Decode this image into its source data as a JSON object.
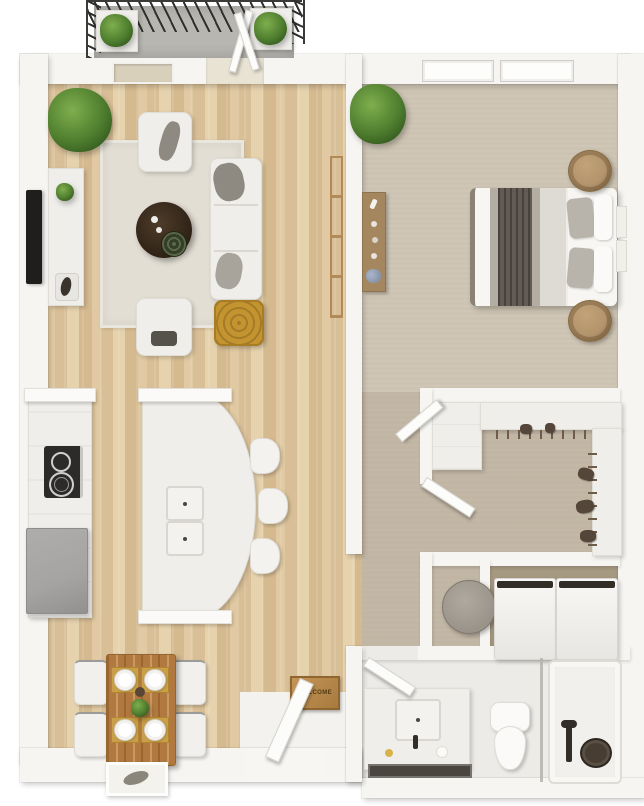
{
  "scene": {
    "type": "3d-floor-plan-top-view",
    "description": "One-bedroom apartment 3D floor plan, top-down render",
    "welcome_sign_text": "WELCOME"
  },
  "rooms": [
    {
      "name": "balcony",
      "features": [
        "railing",
        "planter",
        "planter",
        "open-glass-door"
      ]
    },
    {
      "name": "living-room",
      "features": [
        "potted-plant",
        "wall-tv",
        "media-console",
        "area-rug",
        "armchair",
        "armchair",
        "sofa",
        "round-coffee-table",
        "gold-pouf",
        "blanket-ladder",
        "window"
      ]
    },
    {
      "name": "kitchen",
      "features": [
        "wall-counter",
        "cooktop",
        "refrigerator",
        "curved-island",
        "double-sink",
        "bar-stool",
        "bar-stool",
        "bar-stool"
      ]
    },
    {
      "name": "dining-area",
      "features": [
        "wood-table",
        "dining-chair",
        "dining-chair",
        "dining-chair",
        "dining-chair",
        "place-setting-x4",
        "framed-mat"
      ]
    },
    {
      "name": "bedroom",
      "features": [
        "double-bed",
        "grey-blanket",
        "pillows",
        "nightstand",
        "nightstand",
        "console-dresser",
        "potted-plant",
        "window",
        "window",
        "wall-art"
      ]
    },
    {
      "name": "hallway",
      "features": [
        "open-door",
        "open-door"
      ]
    },
    {
      "name": "walk-in-closet",
      "features": [
        "built-in-wardrobe",
        "hanging-rod",
        "hanging-clothes",
        "open-door"
      ]
    },
    {
      "name": "laundry",
      "features": [
        "laundry-basket",
        "washer",
        "dryer"
      ]
    },
    {
      "name": "bathroom",
      "features": [
        "vanity-sink",
        "toilet",
        "bathtub",
        "glass-partition",
        "black-faucet",
        "bath-tray",
        "open-door"
      ]
    },
    {
      "name": "entry",
      "features": [
        "front-door",
        "welcome-sign",
        "entry-tile"
      ]
    }
  ],
  "counts": {
    "bar_stools": 3,
    "dining_chairs": 4,
    "plates": 4,
    "nightstands": 2,
    "bedroom_windows": 2,
    "balcony_planters": 2,
    "hall_doors": 2
  },
  "colors": {
    "wall": "#f6f5f2",
    "wood_a": "#e1caa3",
    "wood_b": "#d9bf97",
    "bedroom_carpet": "#cdc3b2",
    "hall_carpet": "#c1b5a3",
    "laundry_carpet": "#a69982",
    "bathroom_floor": "#edebe7",
    "entry_tile": "#f3f2ee",
    "concrete": "#b7b6b1",
    "rug": "#e2ded4",
    "white_fabric": "#efeeea",
    "grey_throw": "#8f8a81",
    "dark_throw": "#55514b",
    "coffee_table": "#2c2014",
    "pouf_gold": "#c3942f",
    "dining_wood": "#b1793f",
    "placemat_gold": "#c99f49",
    "plant": "#4e7d2e",
    "plant_light": "#7fae4e",
    "plant_dark": "#2f541c",
    "fridge": "#a5a4a2",
    "cooktop": "#2d2b29",
    "blanket": "#b3ada3",
    "runner": "#625b53",
    "nightstand": "#b4946c",
    "dresser": "#a5875f",
    "hanger": "#6e5c49",
    "clothes": "#55463a",
    "basket": "#99938a",
    "fixture": "#332d27",
    "sign_wood": "#a87a3e",
    "door_white": "#fcfcfb",
    "mat_dark": "#4a463f"
  }
}
